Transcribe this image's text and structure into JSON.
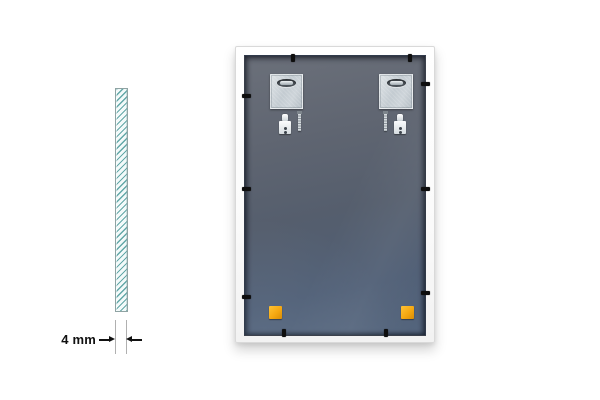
{
  "dimension": {
    "label": "4 mm"
  },
  "colors": {
    "glass_hatch": "#63a8a8",
    "glass_fill": "#f3fafa",
    "ext_gray": "#b0b0b0",
    "arrow_black": "#111111",
    "panel_top": "#6b707a",
    "panel_mid": "#555e6d",
    "panel_bottom": "#54657d",
    "plate_metal": "#c3cbd1",
    "clip_black": "#0e0e0e",
    "pad_orange": "#f5a811"
  },
  "parts": {
    "hanging_plate_count": 2,
    "wall_plug_count": 2,
    "screw_count": 2,
    "retainer_clip_count": 10,
    "bumper_pad_count": 2
  }
}
